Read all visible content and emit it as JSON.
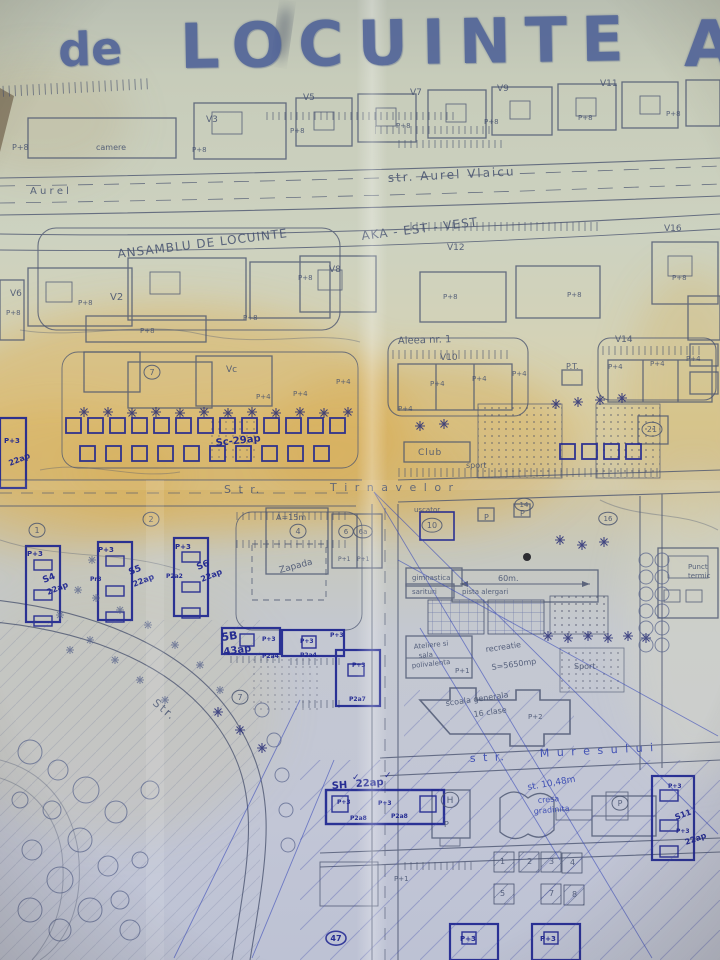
{
  "title": {
    "prefix": "de",
    "main": "LOCUINTE",
    "suffix": "A"
  },
  "palette": {
    "paper": "#cdd2c0",
    "paper_top": "#b9bfb2",
    "stain_yellow": "#dcae4e",
    "pencil_line": "#49536f",
    "ink_navy": "#1e2590",
    "ballpoint_blue": "#3849b8",
    "stamp_blue": "#4d6097",
    "bottom_tint": "#5a6ec8"
  },
  "streets": {
    "north": "str. Aurel Vlaicu",
    "middle": "Str. Tirnavelor",
    "south": "str. Muresului",
    "alley": "Aleea nr. 1",
    "park_street": "Str."
  },
  "district": {
    "line1": "ANSAMBLU DE LOCUINTE",
    "line2": "AKA - EST - VEST"
  },
  "labels": [
    {
      "t": "P+8",
      "x": 12,
      "y": 150,
      "s": 8,
      "c": "pencil"
    },
    {
      "t": "camere",
      "x": 96,
      "y": 150,
      "s": 8,
      "c": "pencil"
    },
    {
      "t": "V3",
      "x": 206,
      "y": 122,
      "s": 9,
      "c": "pencil"
    },
    {
      "t": "P+8",
      "x": 192,
      "y": 152,
      "s": 7,
      "c": "pencil"
    },
    {
      "t": "V5",
      "x": 303,
      "y": 100,
      "s": 9,
      "c": "pencil"
    },
    {
      "t": "V7",
      "x": 410,
      "y": 95,
      "s": 9,
      "c": "pencil"
    },
    {
      "t": "V9",
      "x": 497,
      "y": 91,
      "s": 9,
      "c": "pencil"
    },
    {
      "t": "V11",
      "x": 600,
      "y": 86,
      "s": 9,
      "c": "pencil"
    },
    {
      "t": "P+8",
      "x": 290,
      "y": 133,
      "s": 7,
      "c": "pencil"
    },
    {
      "t": "P+8",
      "x": 396,
      "y": 128,
      "s": 7,
      "c": "pencil"
    },
    {
      "t": "P+8",
      "x": 484,
      "y": 124,
      "s": 7,
      "c": "pencil"
    },
    {
      "t": "P+8",
      "x": 578,
      "y": 120,
      "s": 7,
      "c": "pencil"
    },
    {
      "t": "P+8",
      "x": 666,
      "y": 116,
      "s": 7,
      "c": "pencil"
    },
    {
      "t": "A u r e l",
      "x": 30,
      "y": 194,
      "s": 10,
      "c": "pencil"
    },
    {
      "t": "str.  Aurel   Vlaicu",
      "x": 388,
      "y": 182,
      "r": -3,
      "s": 12,
      "c": "pencil",
      "ls": 2
    },
    {
      "t": "ANSAMBLU  DE  LOCUINTE",
      "x": 118,
      "y": 258,
      "r": -7,
      "s": 12,
      "c": "pencil",
      "ls": 1
    },
    {
      "t": "AKA - EST - VEST",
      "x": 362,
      "y": 240,
      "r": -7,
      "s": 12,
      "c": "pencil",
      "ls": 1
    },
    {
      "t": "V12",
      "x": 447,
      "y": 250,
      "s": 9,
      "c": "pencil"
    },
    {
      "t": "V16",
      "x": 664,
      "y": 231,
      "s": 9,
      "c": "pencil"
    },
    {
      "t": "P+8",
      "x": 672,
      "y": 280,
      "s": 7,
      "c": "pencil"
    },
    {
      "t": "V6",
      "x": 10,
      "y": 296,
      "s": 9,
      "c": "pencil"
    },
    {
      "t": "V2",
      "x": 110,
      "y": 300,
      "s": 10,
      "c": "pencil"
    },
    {
      "t": "P+8",
      "x": 78,
      "y": 305,
      "s": 7,
      "c": "pencil"
    },
    {
      "t": "P+8",
      "x": 140,
      "y": 333,
      "s": 7,
      "c": "pencil"
    },
    {
      "t": "P+8",
      "x": 243,
      "y": 320,
      "s": 7,
      "c": "pencil"
    },
    {
      "t": "V8",
      "x": 329,
      "y": 272,
      "s": 9,
      "c": "pencil"
    },
    {
      "t": "P+8",
      "x": 298,
      "y": 280,
      "s": 7,
      "c": "pencil"
    },
    {
      "t": "P+8",
      "x": 443,
      "y": 299,
      "s": 7,
      "c": "pencil"
    },
    {
      "t": "P+8",
      "x": 567,
      "y": 297,
      "s": 7,
      "c": "pencil"
    },
    {
      "t": "P+8",
      "x": 6,
      "y": 315,
      "s": 7,
      "c": "pencil"
    },
    {
      "t": "Aleea  nr. 1",
      "x": 398,
      "y": 344,
      "r": -2,
      "s": 10,
      "c": "pencil"
    },
    {
      "t": "V14",
      "x": 615,
      "y": 342,
      "s": 9,
      "c": "pencil"
    },
    {
      "t": "V10",
      "x": 440,
      "y": 360,
      "s": 9,
      "c": "pencil"
    },
    {
      "t": "P.T.",
      "x": 566,
      "y": 369,
      "s": 8,
      "c": "pencil"
    },
    {
      "t": "P+4",
      "x": 430,
      "y": 386,
      "s": 7,
      "c": "pencil"
    },
    {
      "t": "P+4",
      "x": 472,
      "y": 381,
      "s": 7,
      "c": "pencil"
    },
    {
      "t": "P+4",
      "x": 512,
      "y": 376,
      "s": 7,
      "c": "pencil"
    },
    {
      "t": "P+4",
      "x": 608,
      "y": 369,
      "s": 7,
      "c": "pencil"
    },
    {
      "t": "P+4",
      "x": 650,
      "y": 366,
      "s": 7,
      "c": "pencil"
    },
    {
      "t": "P+4",
      "x": 686,
      "y": 361,
      "s": 7,
      "c": "pencil"
    },
    {
      "t": "Vc",
      "x": 226,
      "y": 372,
      "s": 9,
      "c": "pencil"
    },
    {
      "t": "7",
      "x": 152,
      "y": 375,
      "s": 8,
      "c": "pencil",
      "circle": true
    },
    {
      "t": "P+4",
      "x": 256,
      "y": 399,
      "s": 7,
      "c": "pencil"
    },
    {
      "t": "P+4",
      "x": 293,
      "y": 396,
      "s": 7,
      "c": "pencil"
    },
    {
      "t": "P+4",
      "x": 336,
      "y": 384,
      "s": 7,
      "c": "pencil"
    },
    {
      "t": "P+4",
      "x": 398,
      "y": 411,
      "s": 7,
      "c": "pencil"
    },
    {
      "t": "Sc-29ap",
      "x": 216,
      "y": 446,
      "r": -6,
      "s": 10,
      "c": "ink"
    },
    {
      "t": "Club",
      "x": 418,
      "y": 455,
      "s": 9,
      "c": "pencil",
      "ls": 1
    },
    {
      "t": "sport",
      "x": 466,
      "y": 468,
      "s": 8,
      "c": "pencil"
    },
    {
      "t": "21",
      "x": 652,
      "y": 432,
      "s": 8,
      "c": "pencil",
      "circle": true
    },
    {
      "t": "P+3",
      "x": 4,
      "y": 443,
      "s": 7,
      "c": "ink"
    },
    {
      "t": "22ap",
      "x": 10,
      "y": 466,
      "r": -22,
      "s": 8,
      "c": "ink"
    },
    {
      "t": "S t r.",
      "x": 224,
      "y": 493,
      "s": 11,
      "c": "pencil",
      "ls": 2
    },
    {
      "t": "T i r n a v e l o r",
      "x": 330,
      "y": 491,
      "s": 11,
      "c": "pencil",
      "ls": 2
    },
    {
      "t": "1",
      "x": 37,
      "y": 533,
      "s": 8,
      "c": "pencil",
      "circle": true
    },
    {
      "t": "2",
      "x": 151,
      "y": 522,
      "s": 8,
      "c": "pencil",
      "circle": true
    },
    {
      "t": "P+3",
      "x": 27,
      "y": 556,
      "s": 7,
      "c": "ink"
    },
    {
      "t": "P+3",
      "x": 98,
      "y": 552,
      "s": 7,
      "c": "ink"
    },
    {
      "t": "P+3",
      "x": 175,
      "y": 549,
      "s": 7,
      "c": "ink"
    },
    {
      "t": "S4",
      "x": 44,
      "y": 583,
      "r": -22,
      "s": 9,
      "c": "ink"
    },
    {
      "t": "22ap",
      "x": 48,
      "y": 595,
      "r": -22,
      "s": 8,
      "c": "ink"
    },
    {
      "t": "S5",
      "x": 130,
      "y": 575,
      "r": -22,
      "s": 9,
      "c": "ink"
    },
    {
      "t": "22ap",
      "x": 134,
      "y": 587,
      "r": -22,
      "s": 8,
      "c": "ink"
    },
    {
      "t": "S6",
      "x": 198,
      "y": 570,
      "r": -22,
      "s": 9,
      "c": "ink"
    },
    {
      "t": "22ap",
      "x": 202,
      "y": 582,
      "r": -22,
      "s": 8,
      "c": "ink"
    },
    {
      "t": "Pr3",
      "x": 90,
      "y": 581,
      "s": 6,
      "c": "ink"
    },
    {
      "t": "P2a2",
      "x": 166,
      "y": 578,
      "s": 6,
      "c": "ink"
    },
    {
      "t": "A=15m",
      "x": 276,
      "y": 520,
      "s": 8,
      "c": "pencil"
    },
    {
      "t": "4",
      "x": 298,
      "y": 534,
      "s": 8,
      "c": "pencil",
      "circle": true
    },
    {
      "t": "Zapada",
      "x": 280,
      "y": 573,
      "r": -15,
      "s": 9,
      "c": "pencil"
    },
    {
      "t": "6",
      "x": 346,
      "y": 534,
      "s": 7,
      "c": "pencil",
      "circle": true
    },
    {
      "t": "6a",
      "x": 363,
      "y": 534,
      "s": 7,
      "c": "pencil",
      "circle": true
    },
    {
      "t": "P+1",
      "x": 338,
      "y": 561,
      "s": 6,
      "c": "pencil"
    },
    {
      "t": "P+1",
      "x": 357,
      "y": 561,
      "s": 6,
      "c": "pencil"
    },
    {
      "t": "uscator",
      "x": 414,
      "y": 512,
      "s": 7,
      "c": "pencil"
    },
    {
      "t": "10",
      "x": 432,
      "y": 528,
      "s": 8,
      "c": "pencil",
      "circle": true
    },
    {
      "t": "P",
      "x": 484,
      "y": 520,
      "s": 8,
      "c": "pencil"
    },
    {
      "t": "P",
      "x": 520,
      "y": 516,
      "s": 8,
      "c": "pencil"
    },
    {
      "t": "14",
      "x": 524,
      "y": 507,
      "s": 7,
      "c": "pencil",
      "circle": true
    },
    {
      "t": "16",
      "x": 608,
      "y": 521,
      "s": 7,
      "c": "pencil",
      "circle": true
    },
    {
      "t": "gimnastica",
      "x": 412,
      "y": 580,
      "s": 7,
      "c": "pencil"
    },
    {
      "t": "sarituri",
      "x": 412,
      "y": 594,
      "s": 7,
      "c": "pencil"
    },
    {
      "t": "60m.",
      "x": 498,
      "y": 581,
      "s": 8,
      "c": "pencil"
    },
    {
      "t": "pista  alergari",
      "x": 462,
      "y": 594,
      "s": 7,
      "c": "pencil"
    },
    {
      "t": "Punct",
      "x": 688,
      "y": 569,
      "s": 7,
      "c": "pencil"
    },
    {
      "t": "termic",
      "x": 688,
      "y": 578,
      "s": 7,
      "c": "pencil"
    },
    {
      "t": "Ateliere si",
      "x": 414,
      "y": 649,
      "r": -6,
      "s": 7,
      "c": "pencil"
    },
    {
      "t": "sala",
      "x": 419,
      "y": 658,
      "r": -6,
      "s": 7,
      "c": "pencil"
    },
    {
      "t": "polivalenta",
      "x": 412,
      "y": 668,
      "r": -6,
      "s": 7,
      "c": "pencil"
    },
    {
      "t": "P+1",
      "x": 455,
      "y": 673,
      "s": 7,
      "c": "pencil"
    },
    {
      "t": "recreatie",
      "x": 486,
      "y": 652,
      "r": -8,
      "s": 8,
      "c": "pencil"
    },
    {
      "t": "S=5650mp",
      "x": 492,
      "y": 670,
      "r": -8,
      "s": 8,
      "c": "pencil"
    },
    {
      "t": "Sport",
      "x": 574,
      "y": 669,
      "s": 8,
      "c": "pencil"
    },
    {
      "t": "scoala generala",
      "x": 446,
      "y": 706,
      "r": -8,
      "s": 8,
      "c": "pencil"
    },
    {
      "t": "16 clase",
      "x": 474,
      "y": 717,
      "r": -8,
      "s": 8,
      "c": "pencil"
    },
    {
      "t": "P+2",
      "x": 528,
      "y": 719,
      "s": 7,
      "c": "pencil"
    },
    {
      "t": "5B",
      "x": 222,
      "y": 641,
      "r": -8,
      "s": 11,
      "c": "ink"
    },
    {
      "t": "43ap",
      "x": 224,
      "y": 655,
      "r": -8,
      "s": 10,
      "c": "ink"
    },
    {
      "t": "P+3",
      "x": 262,
      "y": 641,
      "s": 6,
      "c": "ink"
    },
    {
      "t": "P+3",
      "x": 300,
      "y": 643,
      "s": 6,
      "c": "ink"
    },
    {
      "t": "P+3",
      "x": 330,
      "y": 637,
      "s": 6,
      "c": "ink"
    },
    {
      "t": "P+3",
      "x": 352,
      "y": 667,
      "s": 6,
      "c": "ink"
    },
    {
      "t": "P2a4",
      "x": 262,
      "y": 658,
      "s": 6,
      "c": "ink"
    },
    {
      "t": "P2a4",
      "x": 300,
      "y": 657,
      "s": 6,
      "c": "ink"
    },
    {
      "t": "P2a7",
      "x": 349,
      "y": 701,
      "s": 6,
      "c": "ink"
    },
    {
      "t": "7",
      "x": 240,
      "y": 700,
      "s": 8,
      "c": "pencil",
      "circle": true
    },
    {
      "t": "Str.",
      "x": 152,
      "y": 704,
      "r": 40,
      "s": 11,
      "c": "pencil",
      "ls": 2
    },
    {
      "t": "s t r.",
      "x": 470,
      "y": 762,
      "r": -3,
      "s": 11,
      "c": "blue",
      "ls": 2
    },
    {
      "t": "M u r e s u l u i",
      "x": 540,
      "y": 757,
      "r": -3,
      "s": 11,
      "c": "blue",
      "ls": 2
    },
    {
      "t": "st. 10,48m",
      "x": 528,
      "y": 790,
      "r": -10,
      "s": 9,
      "c": "blue"
    },
    {
      "t": "SH",
      "x": 332,
      "y": 789,
      "r": -4,
      "s": 10,
      "c": "ink"
    },
    {
      "t": "22ap",
      "x": 356,
      "y": 787,
      "r": -4,
      "s": 10,
      "c": "ink"
    },
    {
      "t": "✓",
      "x": 352,
      "y": 780,
      "s": 9,
      "c": "ink"
    },
    {
      "t": "✓",
      "x": 384,
      "y": 778,
      "s": 9,
      "c": "ink"
    },
    {
      "t": "P+3",
      "x": 337,
      "y": 804,
      "s": 6,
      "c": "ink"
    },
    {
      "t": "P+3",
      "x": 378,
      "y": 805,
      "s": 6,
      "c": "ink"
    },
    {
      "t": "P2a8",
      "x": 350,
      "y": 820,
      "s": 6,
      "c": "ink"
    },
    {
      "t": "P2a8",
      "x": 391,
      "y": 818,
      "s": 6,
      "c": "ink"
    },
    {
      "t": "H",
      "x": 450,
      "y": 803,
      "s": 9,
      "c": "pencil",
      "circle": true
    },
    {
      "t": "P",
      "x": 444,
      "y": 827,
      "s": 8,
      "c": "pencil"
    },
    {
      "t": "cresa",
      "x": 538,
      "y": 803,
      "r": -5,
      "s": 8,
      "c": "blue"
    },
    {
      "t": "gradinita",
      "x": 534,
      "y": 814,
      "r": -5,
      "s": 8,
      "c": "blue"
    },
    {
      "t": "P",
      "x": 620,
      "y": 806,
      "s": 8,
      "c": "pencil",
      "circle": true
    },
    {
      "t": "P+3",
      "x": 668,
      "y": 788,
      "s": 6,
      "c": "ink"
    },
    {
      "t": "S11",
      "x": 676,
      "y": 820,
      "r": -20,
      "s": 8,
      "c": "ink"
    },
    {
      "t": "P+3",
      "x": 676,
      "y": 833,
      "s": 6,
      "c": "ink"
    },
    {
      "t": "22ap",
      "x": 686,
      "y": 845,
      "r": -20,
      "s": 8,
      "c": "ink"
    },
    {
      "t": "1",
      "x": 500,
      "y": 864,
      "s": 8,
      "c": "pencil"
    },
    {
      "t": "2",
      "x": 527,
      "y": 864,
      "s": 8,
      "c": "pencil"
    },
    {
      "t": "3",
      "x": 549,
      "y": 864,
      "s": 8,
      "c": "pencil"
    },
    {
      "t": "4",
      "x": 570,
      "y": 865,
      "s": 8,
      "c": "pencil"
    },
    {
      "t": "5",
      "x": 500,
      "y": 896,
      "s": 8,
      "c": "pencil"
    },
    {
      "t": "7",
      "x": 549,
      "y": 896,
      "s": 8,
      "c": "pencil"
    },
    {
      "t": "8",
      "x": 572,
      "y": 897,
      "s": 8,
      "c": "pencil"
    },
    {
      "t": "P+1",
      "x": 394,
      "y": 881,
      "s": 7,
      "c": "pencil"
    },
    {
      "t": "47",
      "x": 336,
      "y": 941,
      "s": 8,
      "c": "ink",
      "circle": true
    },
    {
      "t": "P+3",
      "x": 460,
      "y": 941,
      "s": 7,
      "c": "ink"
    },
    {
      "t": "P+3",
      "x": 540,
      "y": 941,
      "s": 7,
      "c": "ink"
    }
  ]
}
